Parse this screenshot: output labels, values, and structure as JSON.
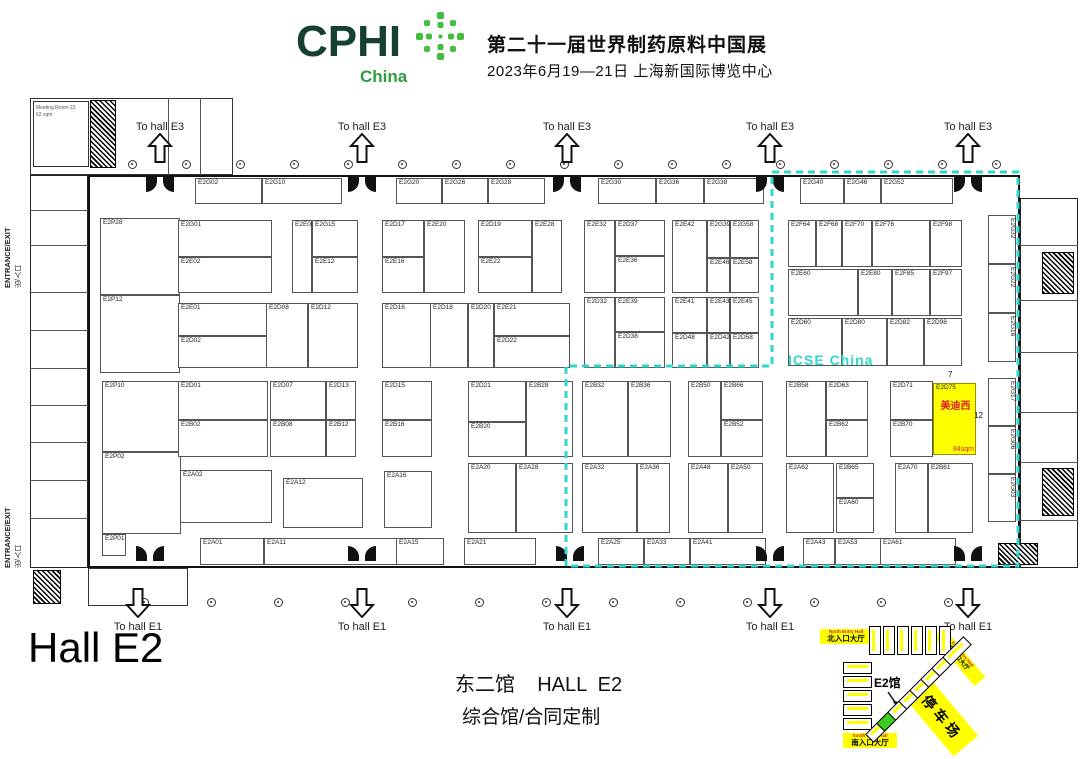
{
  "header": {
    "brand": "CPHI",
    "region": "China",
    "title_line1": "第二十一届世界制药原料中国展",
    "title_line2": "2023年6月19—21日 上海新国际博览中心"
  },
  "labels": {
    "to_hall_e3": "To hall E3",
    "to_hall_e1": "To hall E1",
    "entrance_exit": "ENTRANCE/EXIT",
    "entrance_exit_cn": "出/入口",
    "icse_zone": "ICSE China",
    "hall_big": "Hall E2",
    "footer_line1": "东二馆    HALL  E2",
    "footer_line2": "综合馆/合同定制",
    "meeting_room": "Meeting Room 23",
    "meeting_room_area": "62 sqm"
  },
  "highlight_booth": {
    "code": "E2D75",
    "company": "美迪西",
    "area": "84sqm",
    "width_note": "7",
    "depth_note": "12",
    "fill": "#ffff00",
    "text_color": "#e02020"
  },
  "colors": {
    "brand_dark_green": "#16402f",
    "brand_green": "#2e9b3e",
    "starburst_green": "#43bd3f",
    "zone_dashed_cyan": "#2fd6cd",
    "highlight_yellow": "#ffff00",
    "minimap_green_hall": "#3ecc22"
  },
  "booths": [
    [
      "E2G02",
      195,
      178,
      67,
      26
    ],
    [
      "E2G10",
      262,
      178,
      80,
      26
    ],
    [
      "E2G20",
      396,
      178,
      46,
      26
    ],
    [
      "E2G26",
      442,
      178,
      46,
      26
    ],
    [
      "E2G28",
      488,
      178,
      57,
      26
    ],
    [
      "E2G30",
      598,
      178,
      58,
      26
    ],
    [
      "E2G36",
      656,
      178,
      48,
      26
    ],
    [
      "E2G38",
      704,
      178,
      60,
      26
    ],
    [
      "E2G40",
      800,
      178,
      44,
      26
    ],
    [
      "E2G46",
      844,
      178,
      37,
      26
    ],
    [
      "E2G52",
      881,
      178,
      72,
      26
    ],
    [
      "E2P28",
      100,
      218,
      80,
      77
    ],
    [
      "E2P12",
      100,
      295,
      80,
      78
    ],
    [
      "E2P10",
      102,
      381,
      79,
      71
    ],
    [
      "E2P02",
      102,
      452,
      79,
      82
    ],
    [
      "E2P01",
      102,
      534,
      24,
      22
    ],
    [
      "E2G01",
      178,
      220,
      94,
      37
    ],
    [
      "E2E02",
      178,
      257,
      94,
      36
    ],
    [
      "E2E08",
      292,
      220,
      20,
      73
    ],
    [
      "E2G15",
      312,
      220,
      46,
      37
    ],
    [
      "E2E12",
      312,
      257,
      46,
      36
    ],
    [
      "E2D17",
      382,
      220,
      42,
      37
    ],
    [
      "E2E16",
      382,
      257,
      42,
      36
    ],
    [
      "E2E20",
      424,
      220,
      41,
      73
    ],
    [
      "E2D19",
      478,
      220,
      54,
      37
    ],
    [
      "E2E22",
      478,
      257,
      54,
      36
    ],
    [
      "E2E28",
      532,
      220,
      30,
      73
    ],
    [
      "E2E32",
      584,
      220,
      31,
      73
    ],
    [
      "E2D37",
      615,
      220,
      50,
      36
    ],
    [
      "E2E36",
      615,
      256,
      50,
      37
    ],
    [
      "E2E42",
      672,
      220,
      35,
      73
    ],
    [
      "E2G39",
      707,
      220,
      23,
      38
    ],
    [
      "E2E46",
      707,
      258,
      23,
      35
    ],
    [
      "E2G58",
      730,
      220,
      29,
      38
    ],
    [
      "E2E58",
      730,
      258,
      29,
      35
    ],
    [
      "E2F64",
      788,
      220,
      28,
      47
    ],
    [
      "E2F68",
      816,
      220,
      26,
      47
    ],
    [
      "E2F70",
      842,
      220,
      30,
      47
    ],
    [
      "E2F76",
      872,
      220,
      58,
      47
    ],
    [
      "E2F98",
      930,
      220,
      32,
      47
    ],
    [
      "E2E60",
      788,
      269,
      70,
      47
    ],
    [
      "E2E80",
      858,
      269,
      34,
      47
    ],
    [
      "E2F85",
      892,
      269,
      38,
      47
    ],
    [
      "E2F97",
      930,
      269,
      32,
      47
    ],
    [
      "E2D60",
      788,
      318,
      54,
      48
    ],
    [
      "E2D80",
      842,
      318,
      45,
      48
    ],
    [
      "E2D82",
      887,
      318,
      37,
      48
    ],
    [
      "E2D98",
      924,
      318,
      38,
      48
    ],
    [
      "E2E01",
      178,
      303,
      90,
      33
    ],
    [
      "E2D02",
      178,
      336,
      90,
      32
    ],
    [
      "E2D08",
      266,
      303,
      42,
      65
    ],
    [
      "E2D12",
      308,
      303,
      50,
      65
    ],
    [
      "E2D16",
      382,
      303,
      50,
      65
    ],
    [
      "E2D18",
      430,
      303,
      38,
      65
    ],
    [
      "E2D20",
      468,
      303,
      26,
      65
    ],
    [
      "E2E21",
      494,
      303,
      76,
      33
    ],
    [
      "E2D22",
      494,
      336,
      76,
      32
    ],
    [
      "E2D32",
      584,
      297,
      31,
      71
    ],
    [
      "E2E39",
      615,
      297,
      50,
      35
    ],
    [
      "E2D38",
      615,
      332,
      50,
      36
    ],
    [
      "E2E41",
      672,
      297,
      35,
      36
    ],
    [
      "E2D48",
      672,
      333,
      35,
      35
    ],
    [
      "E2E43",
      707,
      297,
      23,
      36
    ],
    [
      "E2D42",
      707,
      333,
      23,
      35
    ],
    [
      "E2E45",
      730,
      297,
      29,
      36
    ],
    [
      "E2D58",
      730,
      333,
      29,
      35
    ],
    [
      "E2D01",
      178,
      381,
      90,
      39
    ],
    [
      "E2B02",
      178,
      420,
      90,
      37
    ],
    [
      "E2D07",
      270,
      381,
      56,
      39
    ],
    [
      "E2B08",
      270,
      420,
      56,
      37
    ],
    [
      "E2D13",
      326,
      381,
      30,
      39
    ],
    [
      "E2B12",
      326,
      420,
      30,
      37
    ],
    [
      "E2D15",
      382,
      381,
      50,
      39
    ],
    [
      "E2B16",
      382,
      420,
      50,
      37
    ],
    [
      "E2D21",
      468,
      381,
      58,
      41
    ],
    [
      "E2B20",
      468,
      422,
      58,
      35
    ],
    [
      "E2B28",
      526,
      381,
      47,
      76
    ],
    [
      "E2B32",
      582,
      381,
      46,
      76
    ],
    [
      "E2B36",
      628,
      381,
      43,
      76
    ],
    [
      "E2B50",
      688,
      381,
      33,
      76
    ],
    [
      "E2B66",
      721,
      381,
      42,
      39
    ],
    [
      "E2B52",
      721,
      420,
      42,
      37
    ],
    [
      "E2B58",
      786,
      381,
      40,
      76
    ],
    [
      "E2D63",
      826,
      381,
      42,
      39
    ],
    [
      "E2B62",
      826,
      420,
      42,
      37
    ],
    [
      "E2D71",
      890,
      381,
      43,
      39
    ],
    [
      "E2B70",
      890,
      420,
      43,
      37
    ],
    [
      "E2D75",
      933,
      383,
      43,
      72,
      "y"
    ],
    [
      "E2A02",
      180,
      470,
      92,
      53
    ],
    [
      "E2A12",
      283,
      478,
      80,
      50
    ],
    [
      "E2A16",
      384,
      471,
      48,
      57
    ],
    [
      "E2A20",
      468,
      463,
      48,
      70
    ],
    [
      "E2A28",
      516,
      463,
      57,
      70
    ],
    [
      "E2A32",
      582,
      463,
      55,
      70
    ],
    [
      "E2A36",
      637,
      463,
      33,
      70
    ],
    [
      "E2A48",
      688,
      463,
      40,
      70
    ],
    [
      "E2A50",
      728,
      463,
      35,
      70
    ],
    [
      "E2A62",
      786,
      463,
      48,
      70
    ],
    [
      "E2B65",
      836,
      463,
      38,
      35
    ],
    [
      "E2A60",
      836,
      498,
      38,
      35
    ],
    [
      "E2A70",
      895,
      463,
      33,
      70
    ],
    [
      "E2B61",
      928,
      463,
      45,
      70
    ],
    [
      "E2A01",
      200,
      538,
      64,
      27
    ],
    [
      "E2A11",
      264,
      538,
      140,
      27
    ],
    [
      "E2A15",
      396,
      538,
      48,
      27
    ],
    [
      "E2A21",
      464,
      538,
      72,
      27
    ],
    [
      "E2A25",
      598,
      538,
      46,
      27
    ],
    [
      "E2A33",
      644,
      538,
      46,
      27
    ],
    [
      "E2A41",
      690,
      538,
      76,
      27
    ],
    [
      "E2A43",
      803,
      538,
      32,
      27
    ],
    [
      "E2A53",
      835,
      538,
      46,
      27
    ],
    [
      "E2A61",
      880,
      538,
      76,
      27
    ],
    [
      "E2G32",
      988,
      215,
      28,
      49,
      "v"
    ],
    [
      "E2G22",
      988,
      264,
      28,
      49,
      "v"
    ],
    [
      "E2G16",
      988,
      313,
      28,
      49,
      "v"
    ],
    [
      "E2G17",
      988,
      378,
      28,
      48,
      "v"
    ],
    [
      "E2G06",
      988,
      426,
      28,
      48,
      "v"
    ],
    [
      "E2G03",
      988,
      474,
      28,
      48,
      "v"
    ]
  ],
  "annotations": [
    {
      "text": "7",
      "x": 948,
      "y": 370
    },
    {
      "text": "12",
      "x": 974,
      "y": 411
    }
  ],
  "icse_zone_outline": "772,172 1018,172 1018,566 566,566 566,366 772,366 772,172",
  "arrows": {
    "top_x": [
      160,
      362,
      567,
      770,
      968
    ],
    "bottom_x": [
      138,
      362,
      567,
      770,
      968
    ]
  },
  "doors": {
    "top_x": [
      160,
      362,
      567,
      770,
      968
    ],
    "bottom_x": [
      150,
      362,
      570,
      770,
      968
    ]
  },
  "markers": {
    "top": {
      "y": 160,
      "from": 128,
      "to": 1006,
      "step": 54
    },
    "bottom": {
      "y": 598,
      "from": 140,
      "to": 944,
      "step": 67
    }
  },
  "minimap": {
    "north_label": {
      "en": "North Entry Hall",
      "cn": "北入口大厅"
    },
    "south_label": {
      "en": "South Entry Hall",
      "cn": "南入口大厅"
    },
    "east_label": {
      "en": "East Entry Hall",
      "cn": "东入口大厅"
    },
    "parking": "停车场",
    "hall_tag": "E2馆",
    "top_row": {
      "x": 869,
      "y": 626,
      "count": 6,
      "w": 12,
      "h": 29,
      "gap": 2
    },
    "left_col": {
      "x": 843,
      "y": 662,
      "count": 5,
      "w": 29,
      "h": 12,
      "gap": 2
    },
    "diag": {
      "x": 880,
      "y": 728,
      "count": 8,
      "w": 30,
      "h": 12,
      "step": 11,
      "green_index": 1
    }
  }
}
